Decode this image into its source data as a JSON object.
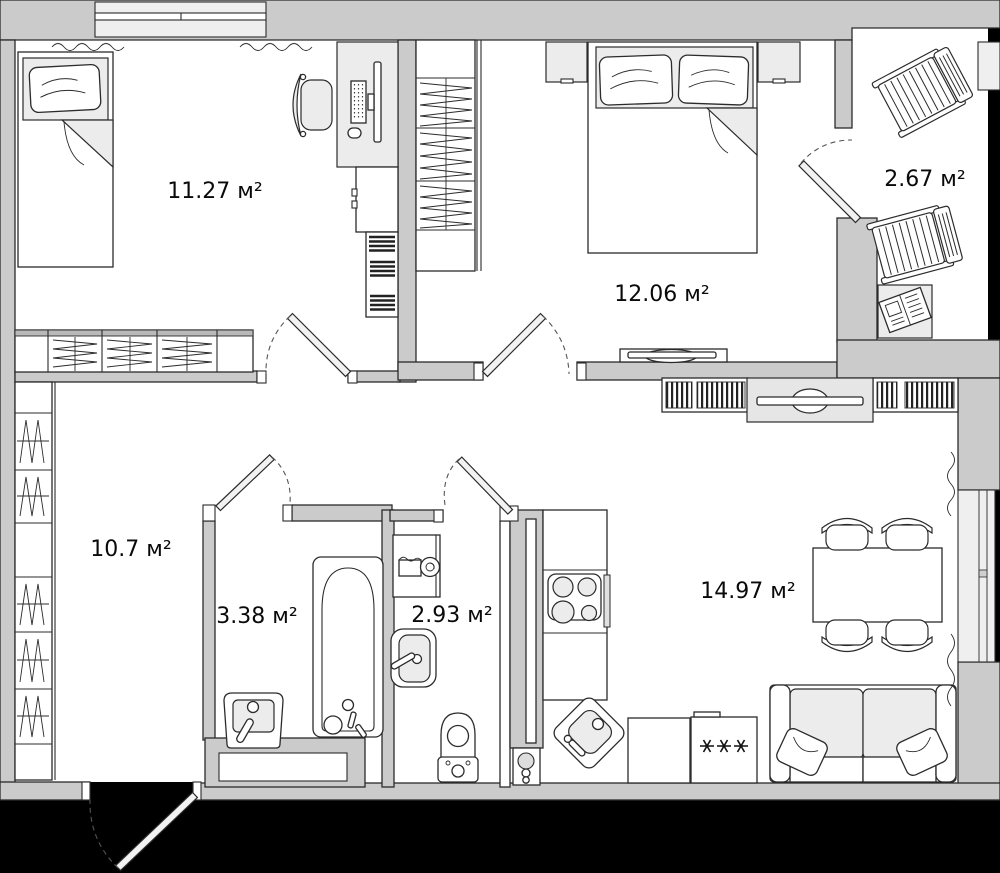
{
  "plan": {
    "type": "apartment-floor-plan",
    "units": "м²",
    "rooms": [
      {
        "id": "bedroom-1",
        "label": "11.27 м²"
      },
      {
        "id": "bedroom-2",
        "label": "12.06 м²"
      },
      {
        "id": "balcony",
        "label": "2.67 м²"
      },
      {
        "id": "hallway",
        "label": "10.7 м²"
      },
      {
        "id": "bathroom",
        "label": "3.38 м²"
      },
      {
        "id": "wc",
        "label": "2.93 м²"
      },
      {
        "id": "kitchen-living",
        "label": "14.97 м²"
      }
    ],
    "icons": [
      {
        "name": "single-bed-icon"
      },
      {
        "name": "double-bed-icon"
      },
      {
        "name": "pillow-icon"
      },
      {
        "name": "desk-computer-icon"
      },
      {
        "name": "office-chair-icon"
      },
      {
        "name": "bookshelf-icon"
      },
      {
        "name": "wardrobe-hanging-icon"
      },
      {
        "name": "chest-of-drawers-icon"
      },
      {
        "name": "nightstand-icon"
      },
      {
        "name": "tv-icon"
      },
      {
        "name": "lounge-chair-icon"
      },
      {
        "name": "balcony-table-newspaper-icon"
      },
      {
        "name": "bathtub-icon"
      },
      {
        "name": "washbasin-icon"
      },
      {
        "name": "washing-machine-icon"
      },
      {
        "name": "toilet-icon"
      },
      {
        "name": "stove-icon"
      },
      {
        "name": "corner-sink-icon"
      },
      {
        "name": "freezer-stars-icon",
        "glyph": "✳✳✳"
      },
      {
        "name": "dining-table-icon"
      },
      {
        "name": "dining-chair-icon"
      },
      {
        "name": "sofa-icon"
      },
      {
        "name": "door-swing-icon"
      },
      {
        "name": "window-squiggle-icon"
      },
      {
        "name": "utility-meters-icon"
      }
    ],
    "colors": {
      "wall": "#cbcbcb",
      "floor": "#ffffff",
      "furniture": "#ffffff",
      "furniture_shade": "#ececec",
      "glazing": "#efefef",
      "outside": "#000000",
      "line": "#2b2b2b"
    }
  }
}
